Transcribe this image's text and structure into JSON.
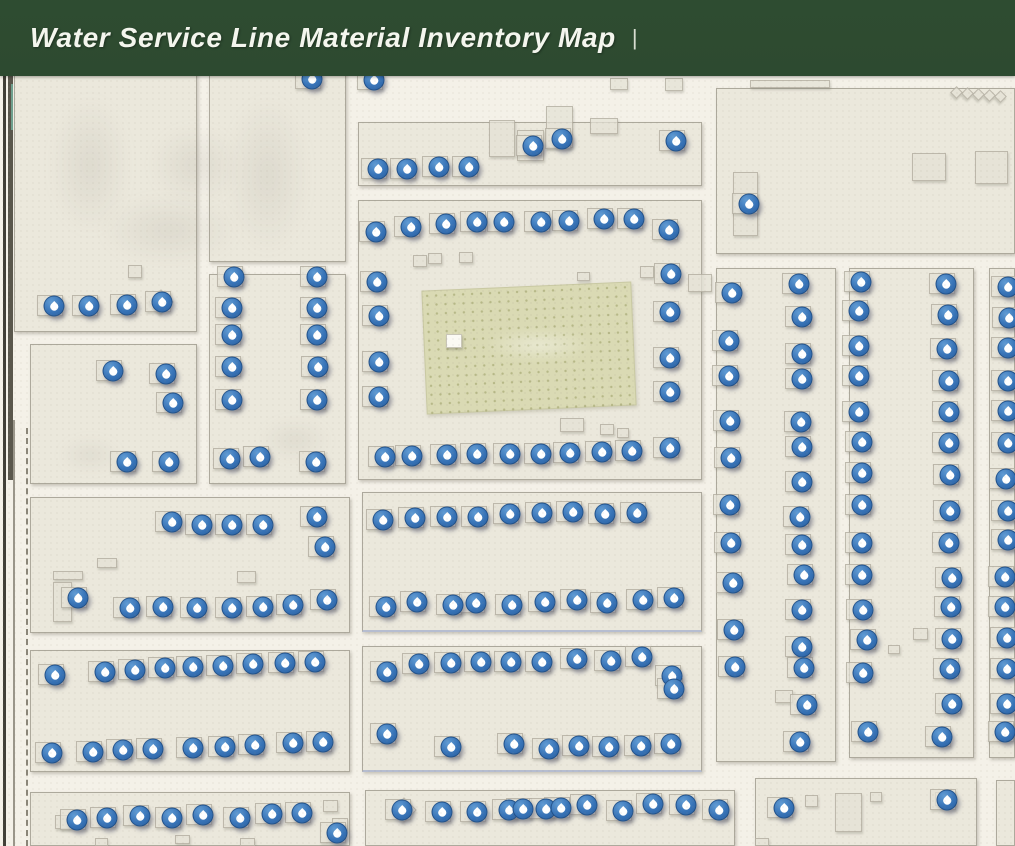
{
  "header": {
    "title": "Water Service Line Material Inventory Map",
    "separator": "|",
    "background_color": "#2d4a30",
    "text_color": "#f4f6ee"
  },
  "map": {
    "background_color": "#f4f1e8",
    "block_fill": "#ebe8dc",
    "park_fill": "#dadab4",
    "marker_color": "#3874b8",
    "marker_icon": "water-droplet",
    "marker_count": 222,
    "park": {
      "x": 424,
      "y": 286,
      "w": 208,
      "h": 122,
      "rotate": -2.5
    },
    "park_hut": {
      "x": 446,
      "y": 334,
      "w": 14,
      "h": 12
    },
    "blocks": [
      [
        14,
        60,
        183,
        272,
        0
      ],
      [
        209,
        60,
        137,
        202,
        0
      ],
      [
        209,
        274,
        137,
        210,
        0
      ],
      [
        30,
        344,
        167,
        140,
        0
      ],
      [
        358,
        122,
        344,
        64,
        0
      ],
      [
        358,
        200,
        344,
        280,
        0
      ],
      [
        716,
        88,
        299,
        166,
        0
      ],
      [
        716,
        268,
        120,
        494,
        0
      ],
      [
        849,
        268,
        125,
        490,
        0
      ],
      [
        989,
        268,
        26,
        490,
        0
      ],
      [
        30,
        497,
        320,
        136,
        0
      ],
      [
        362,
        492,
        340,
        140,
        1
      ],
      [
        30,
        650,
        320,
        122,
        0
      ],
      [
        362,
        646,
        340,
        126,
        1
      ],
      [
        30,
        792,
        320,
        54,
        0
      ],
      [
        365,
        790,
        370,
        56,
        0
      ],
      [
        755,
        778,
        222,
        68,
        0
      ],
      [
        996,
        780,
        19,
        66,
        0
      ]
    ],
    "buildings": [
      [
        489,
        120,
        26,
        37,
        0
      ],
      [
        517,
        130,
        27,
        31,
        0
      ],
      [
        546,
        106,
        27,
        42,
        0
      ],
      [
        590,
        118,
        28,
        16,
        0
      ],
      [
        610,
        78,
        18,
        12,
        0
      ],
      [
        665,
        78,
        18,
        13,
        0
      ],
      [
        750,
        80,
        80,
        8,
        0
      ],
      [
        912,
        153,
        34,
        28,
        0
      ],
      [
        975,
        151,
        33,
        33,
        0
      ],
      [
        733,
        172,
        25,
        64,
        0
      ],
      [
        952,
        88,
        9,
        9,
        45
      ],
      [
        963,
        89,
        9,
        9,
        45
      ],
      [
        974,
        90,
        9,
        9,
        45
      ],
      [
        985,
        91,
        9,
        9,
        45
      ],
      [
        996,
        92,
        9,
        9,
        45
      ],
      [
        413,
        255,
        14,
        12,
        0
      ],
      [
        428,
        253,
        14,
        11,
        0
      ],
      [
        459,
        252,
        14,
        11,
        0
      ],
      [
        577,
        272,
        13,
        9,
        0
      ],
      [
        688,
        274,
        24,
        18,
        0
      ],
      [
        640,
        266,
        14,
        12,
        0
      ],
      [
        560,
        418,
        24,
        14,
        0
      ],
      [
        600,
        424,
        14,
        11,
        0
      ],
      [
        617,
        428,
        12,
        10,
        0
      ],
      [
        128,
        265,
        14,
        13,
        0
      ],
      [
        152,
        293,
        18,
        18,
        45
      ],
      [
        53,
        571,
        30,
        9,
        0
      ],
      [
        53,
        582,
        19,
        40,
        0
      ],
      [
        97,
        558,
        20,
        10,
        0
      ],
      [
        237,
        571,
        19,
        12,
        0
      ],
      [
        55,
        815,
        15,
        14,
        0
      ],
      [
        95,
        838,
        13,
        8,
        0
      ],
      [
        175,
        835,
        15,
        9,
        0
      ],
      [
        240,
        838,
        15,
        8,
        0
      ],
      [
        323,
        800,
        15,
        12,
        0
      ],
      [
        332,
        818,
        16,
        13,
        0
      ],
      [
        395,
        801,
        18,
        18,
        45
      ],
      [
        805,
        795,
        13,
        12,
        0
      ],
      [
        835,
        793,
        27,
        39,
        0
      ],
      [
        870,
        792,
        12,
        10,
        0
      ],
      [
        935,
        792,
        19,
        14,
        0
      ],
      [
        755,
        838,
        14,
        8,
        0
      ],
      [
        913,
        628,
        15,
        12,
        0
      ],
      [
        888,
        645,
        12,
        9,
        0
      ],
      [
        775,
        690,
        18,
        13,
        0
      ]
    ],
    "smudges": [
      [
        50,
        95,
        80,
        140
      ],
      [
        150,
        125,
        90,
        80
      ],
      [
        225,
        95,
        85,
        160
      ],
      [
        100,
        195,
        140,
        70
      ],
      [
        260,
        420,
        70,
        40
      ],
      [
        60,
        440,
        60,
        30
      ]
    ],
    "lines": [
      {
        "x": 3,
        "y": 60,
        "w": 3,
        "h": 786,
        "color": "#413f37",
        "dashed": 0
      },
      {
        "x": 8,
        "y": 60,
        "w": 5,
        "h": 420,
        "color": "#5a574c",
        "dashed": 0
      },
      {
        "x": 11,
        "y": 84,
        "w": 2,
        "h": 46,
        "color": "#6fa08e",
        "dashed": 0
      },
      {
        "x": 13,
        "y": 420,
        "w": 2,
        "h": 426,
        "color": "#9a968a",
        "dashed": 0
      },
      {
        "x": 26,
        "y": 428,
        "w": 0,
        "h": 418,
        "color": "#8a8578",
        "dashed": 1
      }
    ],
    "markers": [
      [
        312,
        79
      ],
      [
        374,
        80
      ],
      [
        54,
        306
      ],
      [
        89,
        306
      ],
      [
        127,
        305
      ],
      [
        162,
        302
      ],
      [
        113,
        371
      ],
      [
        166,
        374
      ],
      [
        173,
        403
      ],
      [
        127,
        462
      ],
      [
        169,
        462
      ],
      [
        234,
        277
      ],
      [
        232,
        308
      ],
      [
        232,
        335
      ],
      [
        232,
        367
      ],
      [
        232,
        400
      ],
      [
        317,
        277
      ],
      [
        317,
        308
      ],
      [
        317,
        335
      ],
      [
        318,
        367
      ],
      [
        317,
        400
      ],
      [
        230,
        459
      ],
      [
        260,
        457
      ],
      [
        316,
        462
      ],
      [
        378,
        169
      ],
      [
        407,
        169
      ],
      [
        439,
        167
      ],
      [
        469,
        167
      ],
      [
        533,
        146
      ],
      [
        562,
        139
      ],
      [
        676,
        141
      ],
      [
        376,
        232
      ],
      [
        411,
        227
      ],
      [
        446,
        224
      ],
      [
        477,
        222
      ],
      [
        504,
        222
      ],
      [
        541,
        222
      ],
      [
        569,
        221
      ],
      [
        604,
        219
      ],
      [
        634,
        219
      ],
      [
        669,
        230
      ],
      [
        377,
        282
      ],
      [
        379,
        316
      ],
      [
        379,
        362
      ],
      [
        379,
        397
      ],
      [
        671,
        274
      ],
      [
        670,
        312
      ],
      [
        670,
        358
      ],
      [
        670,
        392
      ],
      [
        385,
        457
      ],
      [
        412,
        456
      ],
      [
        447,
        455
      ],
      [
        477,
        454
      ],
      [
        510,
        454
      ],
      [
        541,
        454
      ],
      [
        570,
        453
      ],
      [
        602,
        452
      ],
      [
        632,
        451
      ],
      [
        670,
        448
      ],
      [
        749,
        204
      ],
      [
        732,
        293
      ],
      [
        729,
        341
      ],
      [
        729,
        376
      ],
      [
        730,
        421
      ],
      [
        731,
        458
      ],
      [
        730,
        505
      ],
      [
        731,
        543
      ],
      [
        733,
        583
      ],
      [
        734,
        630
      ],
      [
        735,
        667
      ],
      [
        799,
        284
      ],
      [
        802,
        317
      ],
      [
        802,
        354
      ],
      [
        802,
        379
      ],
      [
        801,
        422
      ],
      [
        802,
        447
      ],
      [
        802,
        482
      ],
      [
        800,
        517
      ],
      [
        802,
        545
      ],
      [
        804,
        575
      ],
      [
        802,
        610
      ],
      [
        802,
        647
      ],
      [
        804,
        668
      ],
      [
        807,
        705
      ],
      [
        800,
        742
      ],
      [
        861,
        282
      ],
      [
        859,
        311
      ],
      [
        859,
        346
      ],
      [
        859,
        376
      ],
      [
        859,
        412
      ],
      [
        862,
        442
      ],
      [
        862,
        473
      ],
      [
        862,
        505
      ],
      [
        862,
        543
      ],
      [
        862,
        575
      ],
      [
        863,
        610
      ],
      [
        867,
        640
      ],
      [
        863,
        673
      ],
      [
        868,
        732
      ],
      [
        946,
        284
      ],
      [
        948,
        315
      ],
      [
        947,
        349
      ],
      [
        949,
        381
      ],
      [
        949,
        412
      ],
      [
        949,
        443
      ],
      [
        950,
        475
      ],
      [
        950,
        511
      ],
      [
        949,
        543
      ],
      [
        952,
        578
      ],
      [
        951,
        607
      ],
      [
        952,
        639
      ],
      [
        950,
        669
      ],
      [
        952,
        704
      ],
      [
        942,
        737
      ],
      [
        1008,
        287
      ],
      [
        1009,
        318
      ],
      [
        1008,
        348
      ],
      [
        1008,
        381
      ],
      [
        1008,
        411
      ],
      [
        1008,
        443
      ],
      [
        1006,
        479
      ],
      [
        1008,
        511
      ],
      [
        1008,
        540
      ],
      [
        1005,
        577
      ],
      [
        1005,
        607
      ],
      [
        1007,
        638
      ],
      [
        1007,
        669
      ],
      [
        1007,
        704
      ],
      [
        1005,
        732
      ],
      [
        172,
        522
      ],
      [
        202,
        525
      ],
      [
        232,
        525
      ],
      [
        263,
        525
      ],
      [
        317,
        517
      ],
      [
        325,
        547
      ],
      [
        78,
        598
      ],
      [
        130,
        608
      ],
      [
        163,
        607
      ],
      [
        197,
        608
      ],
      [
        232,
        608
      ],
      [
        263,
        607
      ],
      [
        293,
        605
      ],
      [
        327,
        600
      ],
      [
        383,
        520
      ],
      [
        415,
        518
      ],
      [
        447,
        517
      ],
      [
        478,
        517
      ],
      [
        510,
        514
      ],
      [
        542,
        513
      ],
      [
        573,
        512
      ],
      [
        605,
        514
      ],
      [
        637,
        513
      ],
      [
        386,
        607
      ],
      [
        417,
        602
      ],
      [
        453,
        605
      ],
      [
        476,
        603
      ],
      [
        512,
        605
      ],
      [
        545,
        602
      ],
      [
        577,
        600
      ],
      [
        607,
        603
      ],
      [
        643,
        600
      ],
      [
        674,
        598
      ],
      [
        55,
        675
      ],
      [
        105,
        672
      ],
      [
        135,
        670
      ],
      [
        165,
        668
      ],
      [
        193,
        667
      ],
      [
        223,
        666
      ],
      [
        253,
        664
      ],
      [
        285,
        663
      ],
      [
        315,
        662
      ],
      [
        52,
        753
      ],
      [
        93,
        752
      ],
      [
        123,
        750
      ],
      [
        153,
        749
      ],
      [
        193,
        748
      ],
      [
        225,
        747
      ],
      [
        255,
        745
      ],
      [
        293,
        743
      ],
      [
        323,
        742
      ],
      [
        387,
        672
      ],
      [
        419,
        664
      ],
      [
        451,
        663
      ],
      [
        481,
        662
      ],
      [
        511,
        662
      ],
      [
        542,
        662
      ],
      [
        577,
        659
      ],
      [
        611,
        661
      ],
      [
        642,
        657
      ],
      [
        672,
        676
      ],
      [
        674,
        689
      ],
      [
        387,
        734
      ],
      [
        451,
        747
      ],
      [
        514,
        744
      ],
      [
        549,
        749
      ],
      [
        579,
        746
      ],
      [
        609,
        747
      ],
      [
        641,
        746
      ],
      [
        671,
        744
      ],
      [
        77,
        820
      ],
      [
        107,
        818
      ],
      [
        140,
        816
      ],
      [
        172,
        818
      ],
      [
        203,
        815
      ],
      [
        240,
        818
      ],
      [
        272,
        814
      ],
      [
        302,
        813
      ],
      [
        337,
        833
      ],
      [
        402,
        810
      ],
      [
        442,
        812
      ],
      [
        477,
        812
      ],
      [
        509,
        810
      ],
      [
        523,
        809
      ],
      [
        546,
        809
      ],
      [
        561,
        808
      ],
      [
        587,
        805
      ],
      [
        623,
        811
      ],
      [
        653,
        804
      ],
      [
        686,
        805
      ],
      [
        719,
        810
      ],
      [
        784,
        808
      ],
      [
        947,
        800
      ]
    ]
  }
}
